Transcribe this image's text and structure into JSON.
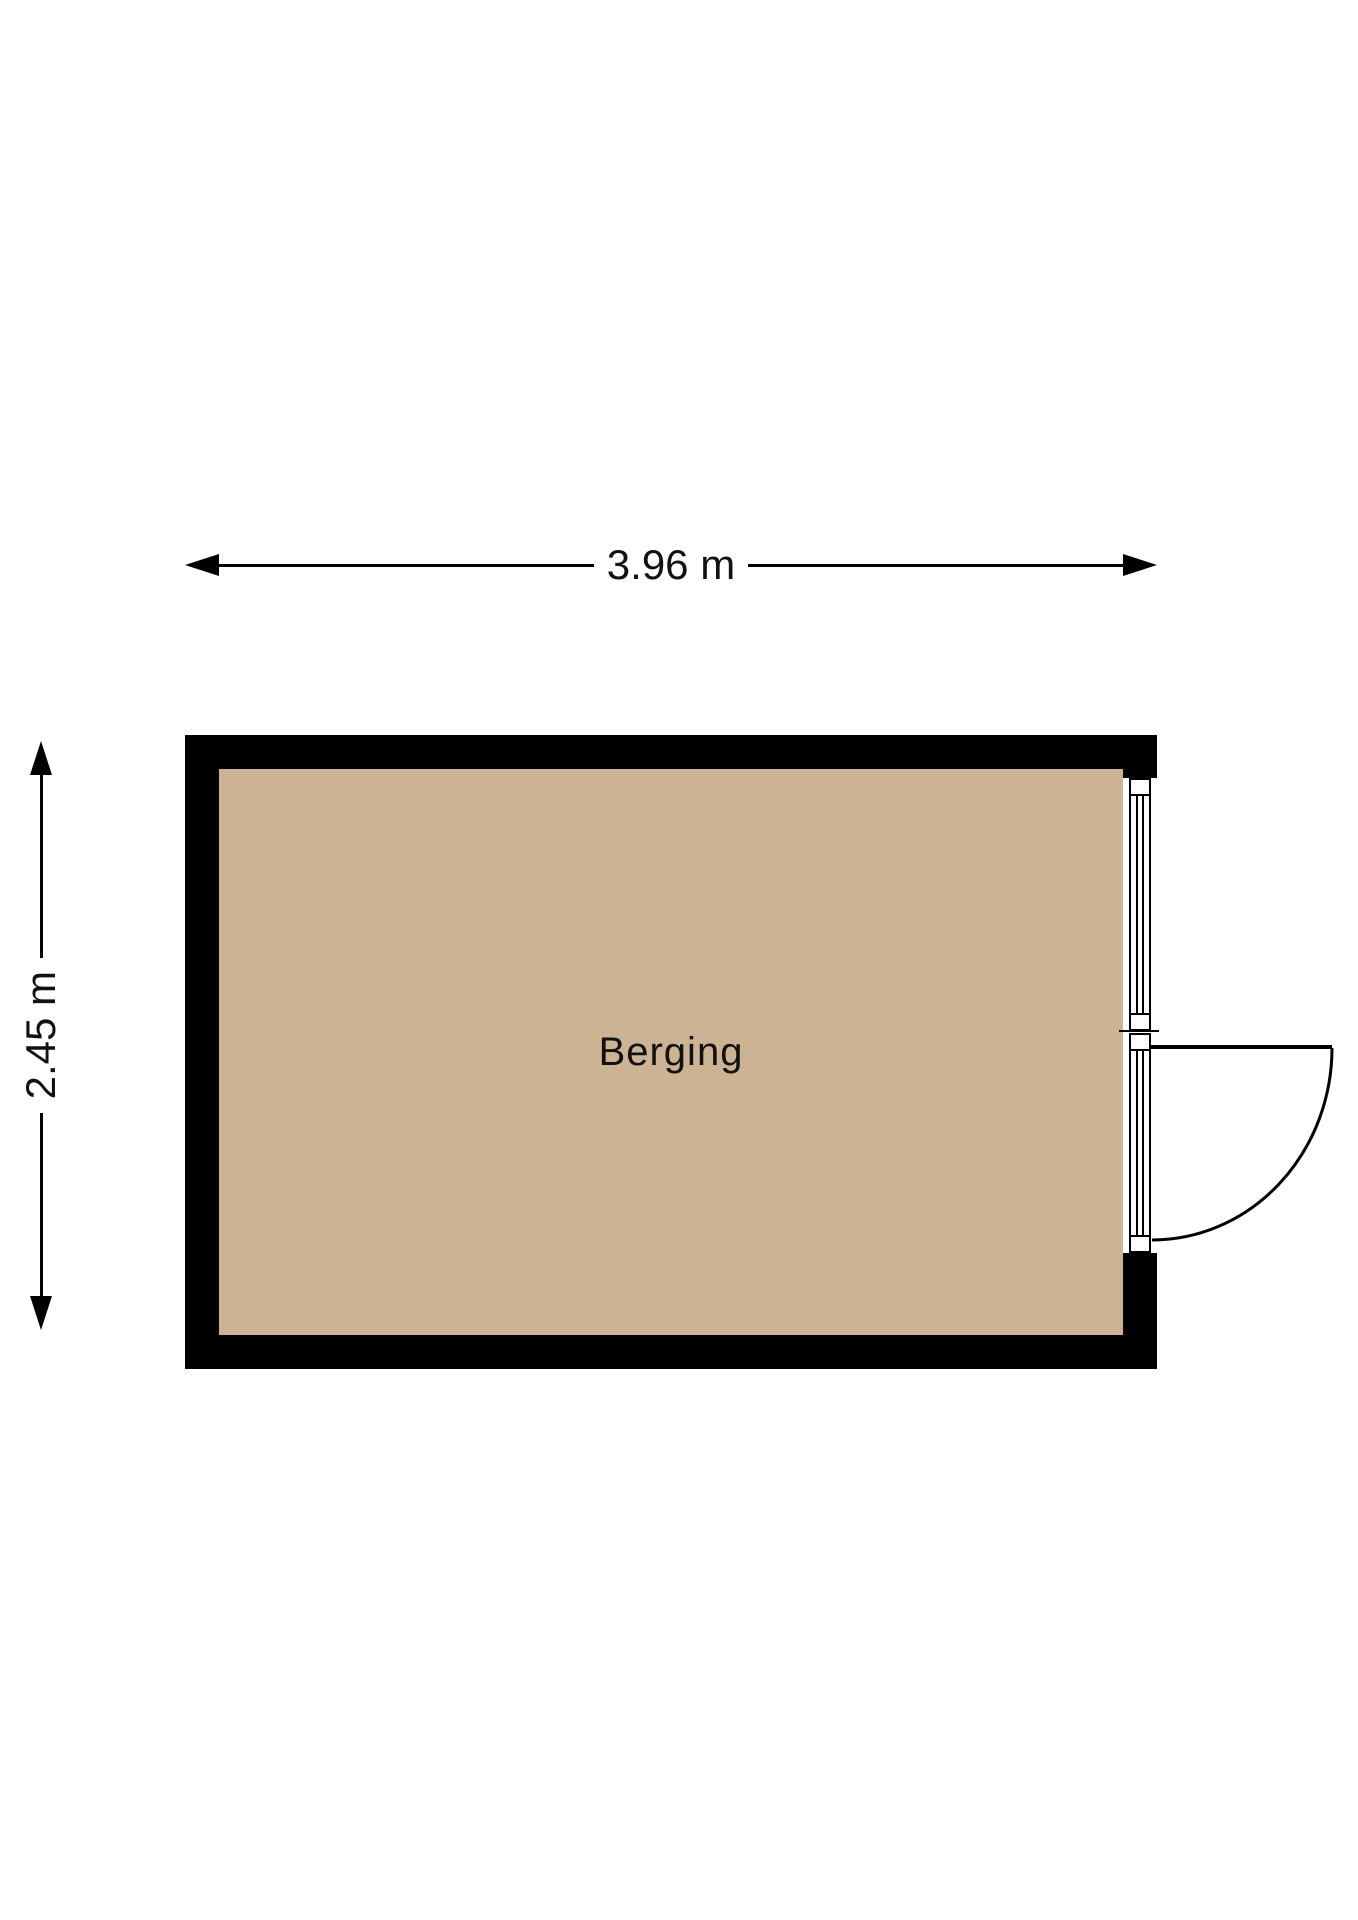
{
  "plan": {
    "room": {
      "name": "Berging",
      "width_label": "3.96 m",
      "height_label": "2.45 m"
    },
    "features": {
      "window": "window-in-right-wall",
      "door": "outward-swing-door-right-wall"
    },
    "colors": {
      "wall": "#000000",
      "floor": "#ccb394",
      "background": "#ffffff",
      "text": "#111111"
    }
  }
}
